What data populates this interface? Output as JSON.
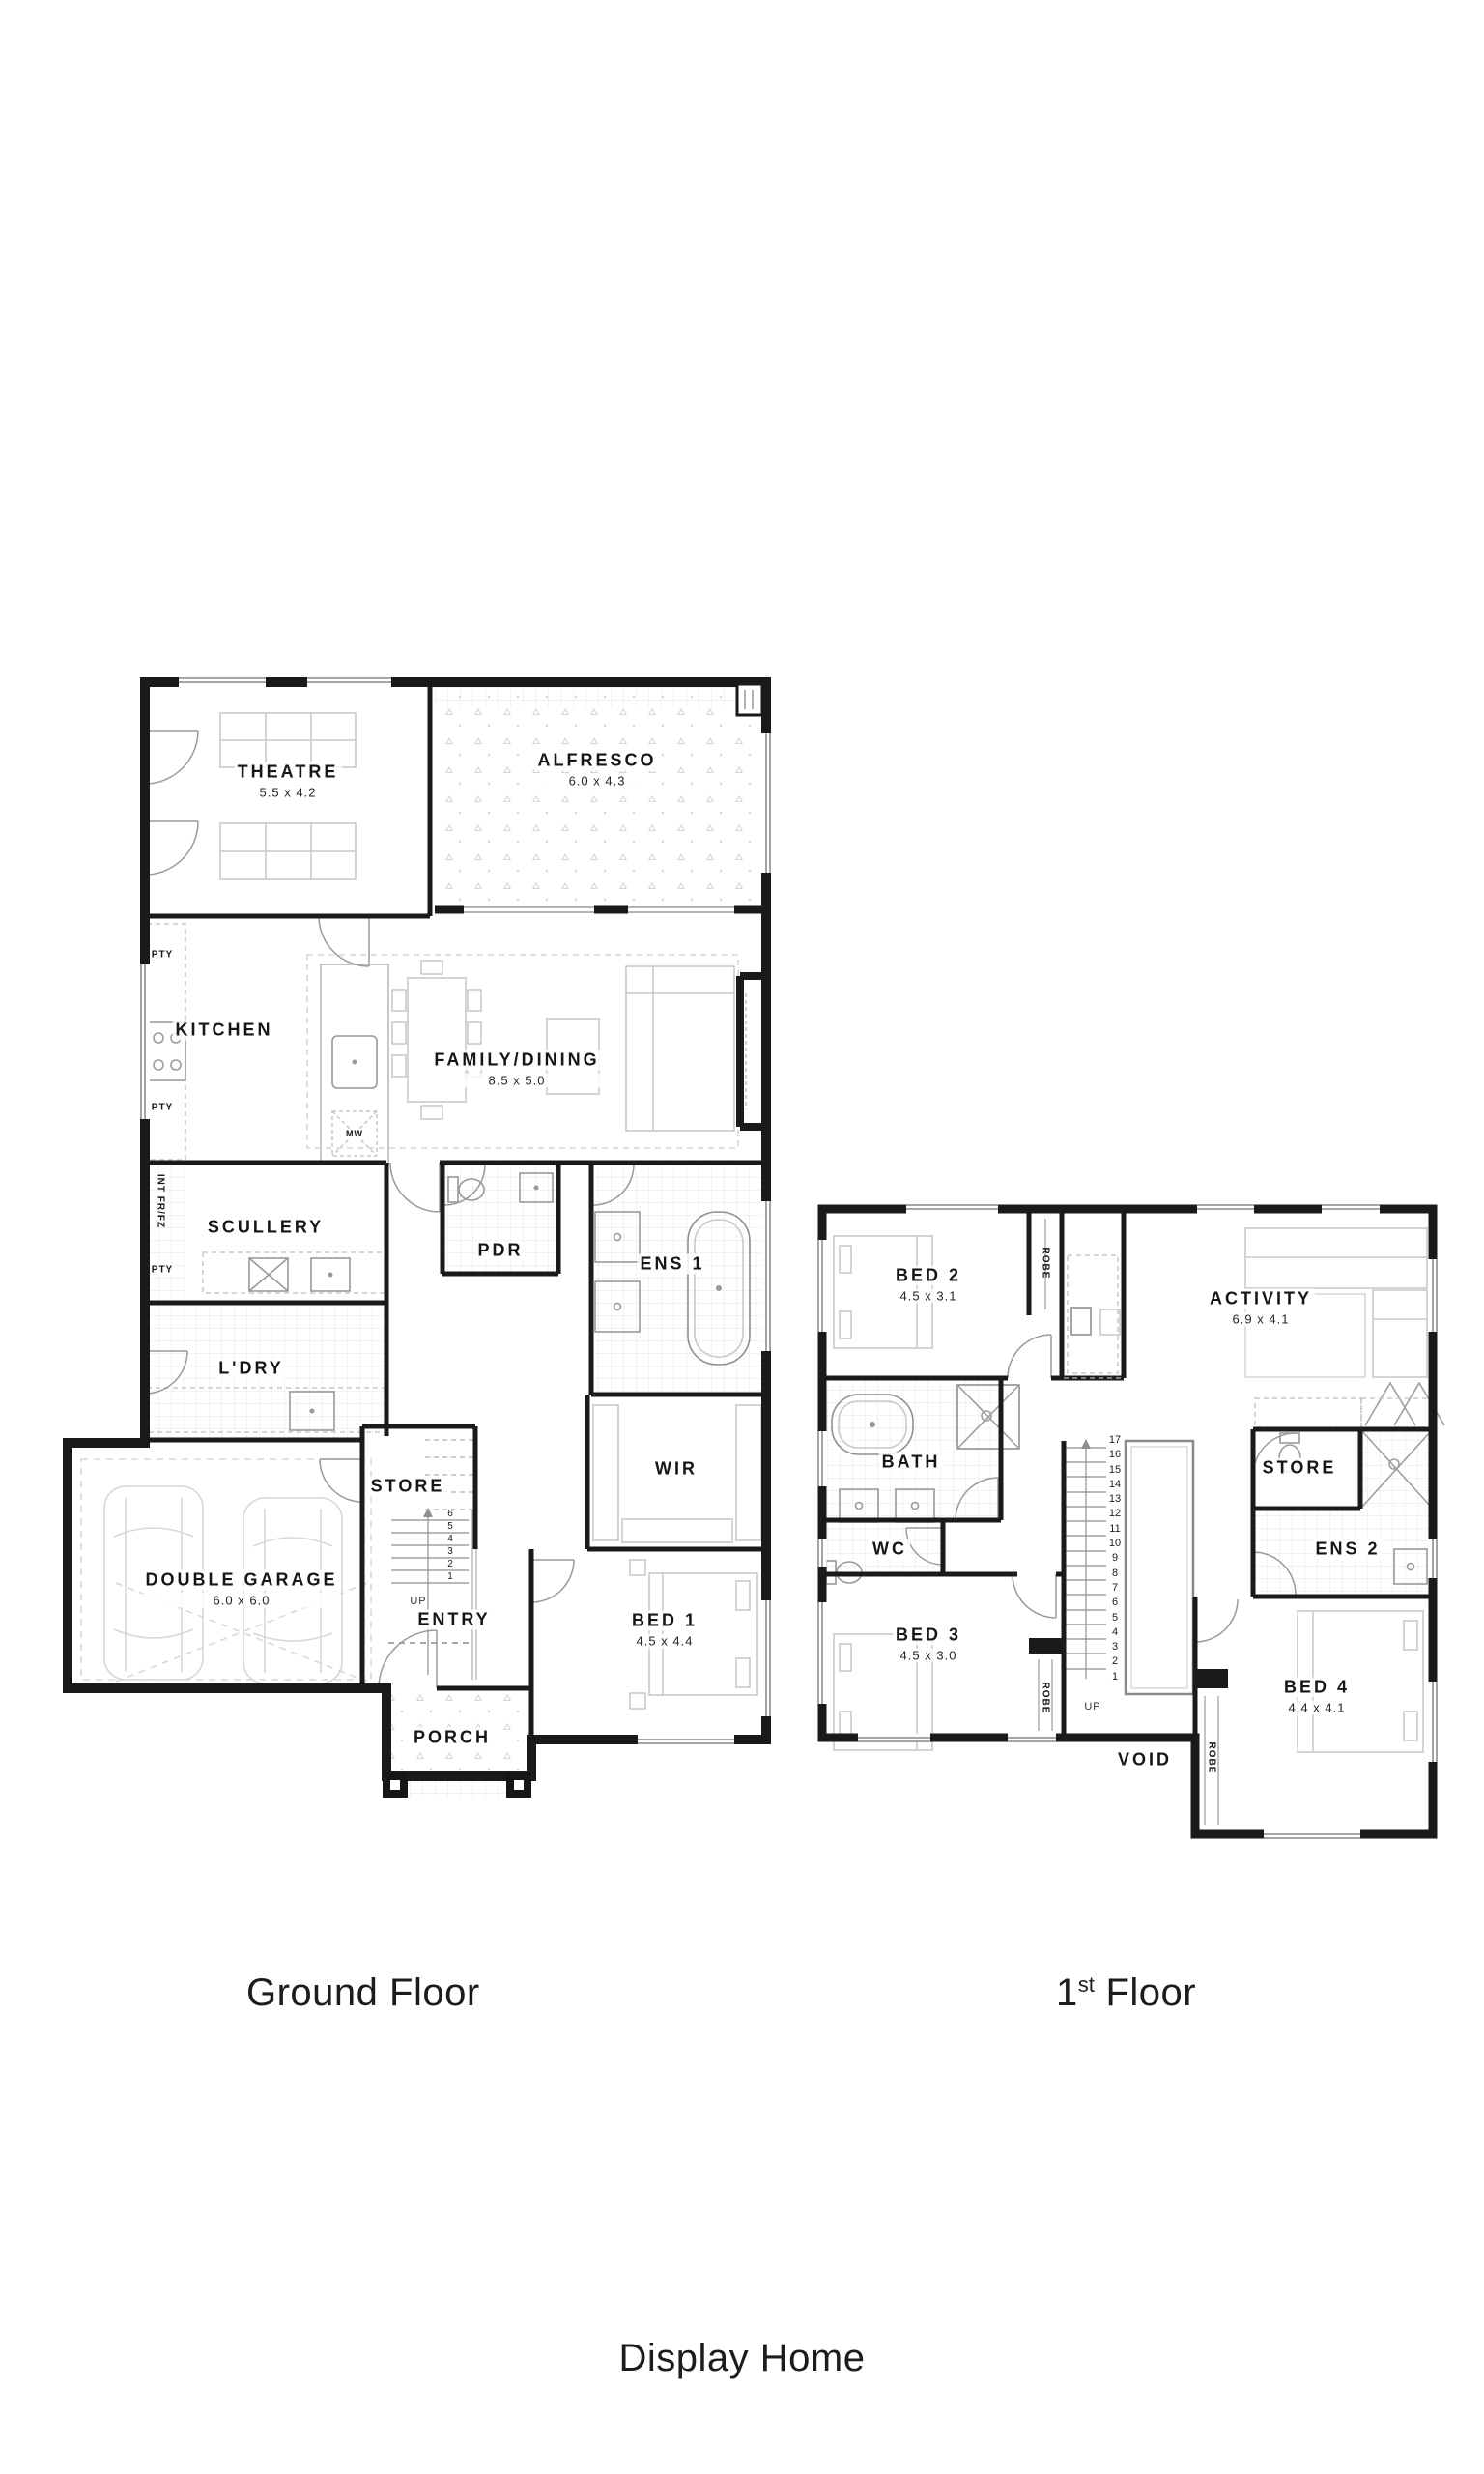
{
  "colors": {
    "wall_ink": "#1a1a1a",
    "paper": "#ffffff",
    "furniture_grey": "#c9c9c9",
    "door_grey": "#9a9a9a"
  },
  "captions": {
    "ground": "Ground Floor",
    "first_number": "1",
    "first_ordinal": "st",
    "first_word": " Floor",
    "footer": "Display Home"
  },
  "ground_floor": {
    "rooms": {
      "theatre": {
        "name": "THEATRE",
        "dims": "5.5 x 4.2"
      },
      "alfresco": {
        "name": "ALFRESCO",
        "dims": "6.0 x 4.3"
      },
      "kitchen": {
        "name": "KITCHEN"
      },
      "family": {
        "name": "FAMILY/DINING",
        "dims": "8.5 x 5.0"
      },
      "scullery": {
        "name": "SCULLERY"
      },
      "pdr": {
        "name": "PDR"
      },
      "ens1": {
        "name": "ENS 1"
      },
      "ldry": {
        "name": "L'DRY"
      },
      "store": {
        "name": "STORE"
      },
      "wir": {
        "name": "WIR"
      },
      "garage": {
        "name": "DOUBLE GARAGE",
        "dims": "6.0 x 6.0"
      },
      "entry": {
        "name": "ENTRY"
      },
      "bed1": {
        "name": "BED 1",
        "dims": "4.5 x 4.4"
      },
      "porch": {
        "name": "PORCH"
      }
    },
    "annotations": {
      "pty": "PTY",
      "int_fridge": "INT FR/FZ",
      "microwave": "MW",
      "up": "UP"
    },
    "stair_numbers": [
      "6",
      "5",
      "4",
      "3",
      "2",
      "1"
    ]
  },
  "first_floor": {
    "rooms": {
      "bed2": {
        "name": "BED 2",
        "dims": "4.5 x 3.1"
      },
      "activity": {
        "name": "ACTIVITY",
        "dims": "6.9 x 4.1"
      },
      "bath": {
        "name": "BATH"
      },
      "wc": {
        "name": "WC"
      },
      "store": {
        "name": "STORE"
      },
      "ens2": {
        "name": "ENS 2"
      },
      "bed3": {
        "name": "BED 3",
        "dims": "4.5 x 3.0"
      },
      "bed4": {
        "name": "BED 4",
        "dims": "4.4 x 4.1"
      },
      "void": {
        "name": "VOID"
      }
    },
    "annotations": {
      "robe": "ROBE",
      "up": "UP"
    },
    "stair_numbers": [
      "17",
      "16",
      "15",
      "14",
      "13",
      "12",
      "11",
      "10",
      "9",
      "8",
      "7",
      "6",
      "5",
      "4",
      "3",
      "2",
      "1"
    ]
  }
}
